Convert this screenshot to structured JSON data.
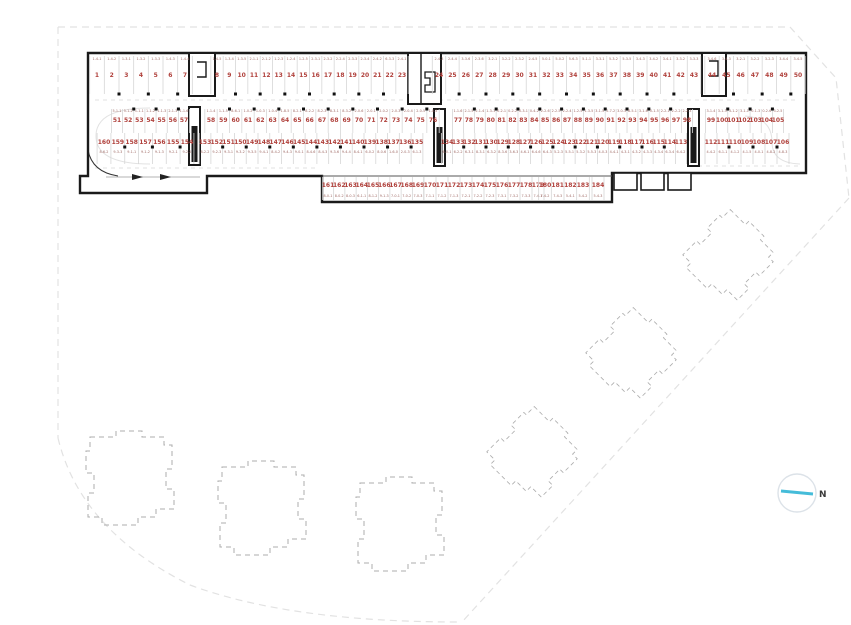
{
  "drawing": {
    "type": "parking-garage-floor-plan",
    "total_spaces": 184,
    "rows": [
      {
        "id": "row1",
        "codes_position": "above",
        "segments": [
          {
            "start": 1,
            "end": 7,
            "codes": [
              "1-4-1",
              "1-4-2",
              "1-3-1",
              "1-3-2",
              "1-3-3",
              "1-4-3",
              "1-4-4"
            ]
          },
          {
            "start": 8,
            "end": 23,
            "codes": [
              "1-4-5",
              "1-3-4",
              "1-3-5",
              "2-1-1",
              "2-1-2",
              "1-2-3",
              "1-2-4",
              "1-2-5",
              "2-3-1",
              "2-3-2",
              "2-2-4",
              "2-3-3",
              "2-3-4",
              "2-4-2",
              "6-3-3",
              "2-4-1"
            ]
          },
          {
            "start": 24,
            "end": 43,
            "codes": [
              "2-4-3",
              "2-4-4",
              "3-3-6",
              "2-3-6",
              "3-2-1",
              "3-2-2",
              "2-3-2",
              "2-4-5",
              "5-0-1",
              "5-0-2",
              "5-6-3",
              "5-1-1",
              "3-3-1",
              "5-3-2",
              "5-3-5",
              "3-4-3",
              "3-4-2",
              "3-4-1",
              "3-3-2",
              "3-3-3"
            ]
          },
          {
            "start": 44,
            "end": 50,
            "codes": [
              "3-4-6",
              "3-4-3",
              "3-2-1",
              "3-2-2",
              "3-2-3",
              "3-4-4",
              "3-4-5"
            ]
          }
        ]
      },
      {
        "id": "row2",
        "codes_position": "above",
        "segments": [
          {
            "start": 51,
            "end": 57,
            "codes": [
              "5-1-1",
              "5-1-2",
              "1-1-1",
              "1-1-2",
              "1-1-3",
              "2-1-3",
              "1-1-6"
            ]
          },
          {
            "start": 58,
            "end": 76,
            "codes": [
              "1-1-4",
              "1-1-5",
              "8-6-1",
              "1-0-2",
              "1-0-3",
              "1-0-4",
              "1-8-5",
              "8-2-1",
              "8-2-2",
              "8-2-3",
              "8-3-1",
              "8-3-2",
              "2-0-6",
              "2-0-1",
              "2-0-2",
              "2-0-3",
              "2-0-4",
              "2-0-5",
              "1-0-5"
            ]
          },
          {
            "start": 77,
            "end": 98,
            "codes": [
              "1-1-6",
              "2-1-5",
              "2-1-4",
              "1-3-1",
              "0-2-1",
              "0-2-2",
              "0-3-1",
              "0-4-2",
              "2-2-6",
              "2-2-5",
              "2-2-4",
              "1-2-5",
              "1-3-5",
              "3-1-5",
              "2-7-2",
              "3-0-3",
              "8-5-1",
              "3-1-6",
              "0-1-5",
              "2-2-1",
              "2-2-2",
              "2-2-3"
            ]
          },
          {
            "start": 99,
            "end": 105,
            "codes": [
              "3-1-4",
              "3-1-3",
              "3-1-2",
              "3-1-1",
              "0-1-3",
              "0-2-6",
              "3-2-5"
            ]
          }
        ]
      },
      {
        "id": "row3",
        "codes_position": "below",
        "segments": [
          {
            "start": 160,
            "end": 154,
            "codes": [
              "8-6-2",
              "9-3-3",
              "9-1-1",
              "9-1-2",
              "9-1-3",
              "9-2-1",
              "9-2-2"
            ]
          },
          {
            "start": 153,
            "end": 135,
            "codes": [
              "8-2-2",
              "9-2-3",
              "9-3-1",
              "9-3-2",
              "9-3-5",
              "9-4-1",
              "8-4-2",
              "9-4-3",
              "9-0-1",
              "8-4-6",
              "8-4-3",
              "9-3-6",
              "9-4-4",
              "8-4-1",
              "6-0-2",
              "8-0-6",
              "1-6-0",
              "2-0-3",
              "6-1-3"
            ]
          },
          {
            "start": 134,
            "end": 113,
            "codes": [
              "6-0-1",
              "6-2-2",
              "6-3-1",
              "8-3-1",
              "6-3-2",
              "8-3-6",
              "3-6-3",
              "4-6-1",
              "6-4-6",
              "6-4-3",
              "5-2-3",
              "5-5-1",
              "5-3-2",
              "5-5-3",
              "4-0-3",
              "4-4-1",
              "4-3-1",
              "4-3-2",
              "4-3-3",
              "4-3-4",
              "6-3-4",
              "6-4-2"
            ]
          },
          {
            "start": 112,
            "end": 106,
            "codes": [
              "4-4-2",
              "6-1-1",
              "4-1-2",
              "4-1-5",
              "4-0-1",
              "4-8-2",
              "4-8-3"
            ]
          }
        ]
      },
      {
        "id": "row4",
        "codes_position": "below",
        "segments": [
          {
            "start": 161,
            "end": 169,
            "codes": [
              "8-0-1",
              "8-0-2",
              "8-0-3",
              "6-1-1",
              "8-1-2",
              "9-1-3",
              "7-0-1",
              "7-0-2",
              "7-0-3"
            ]
          },
          {
            "start": 170,
            "end": 179,
            "codes": [
              "7-1-1",
              "7-1-2",
              "7-1-3",
              "7-2-1",
              "7-2-2",
              "7-2-3",
              "7-3-1",
              "7-3-2",
              "7-3-3",
              "7-4-1"
            ]
          },
          {
            "start": 180,
            "end": 183,
            "codes": [
              "7-4-2",
              "7-4-3",
              "5-4-1",
              "5-4-2"
            ]
          },
          {
            "start": 184,
            "end": 184,
            "codes": [
              "5-4-3"
            ]
          }
        ]
      }
    ],
    "dashed_footprints": {
      "axis_aligned_count": 3,
      "rotated_count": 3
    }
  },
  "compass": {
    "label": "N"
  },
  "colors": {
    "wall": "#1a1a1a",
    "stall_line": "#d6d6d6",
    "number_red": "#b0413c",
    "code_red": "#a06b66",
    "footprint_dash": "#adadad",
    "boundary_dash": "#e2e2e2",
    "lane_dash": "#d8d8d8",
    "needle_cyan": "#45bcd9",
    "compass_ring": "#dce2e8",
    "compass_label": "#3a3a3a"
  }
}
